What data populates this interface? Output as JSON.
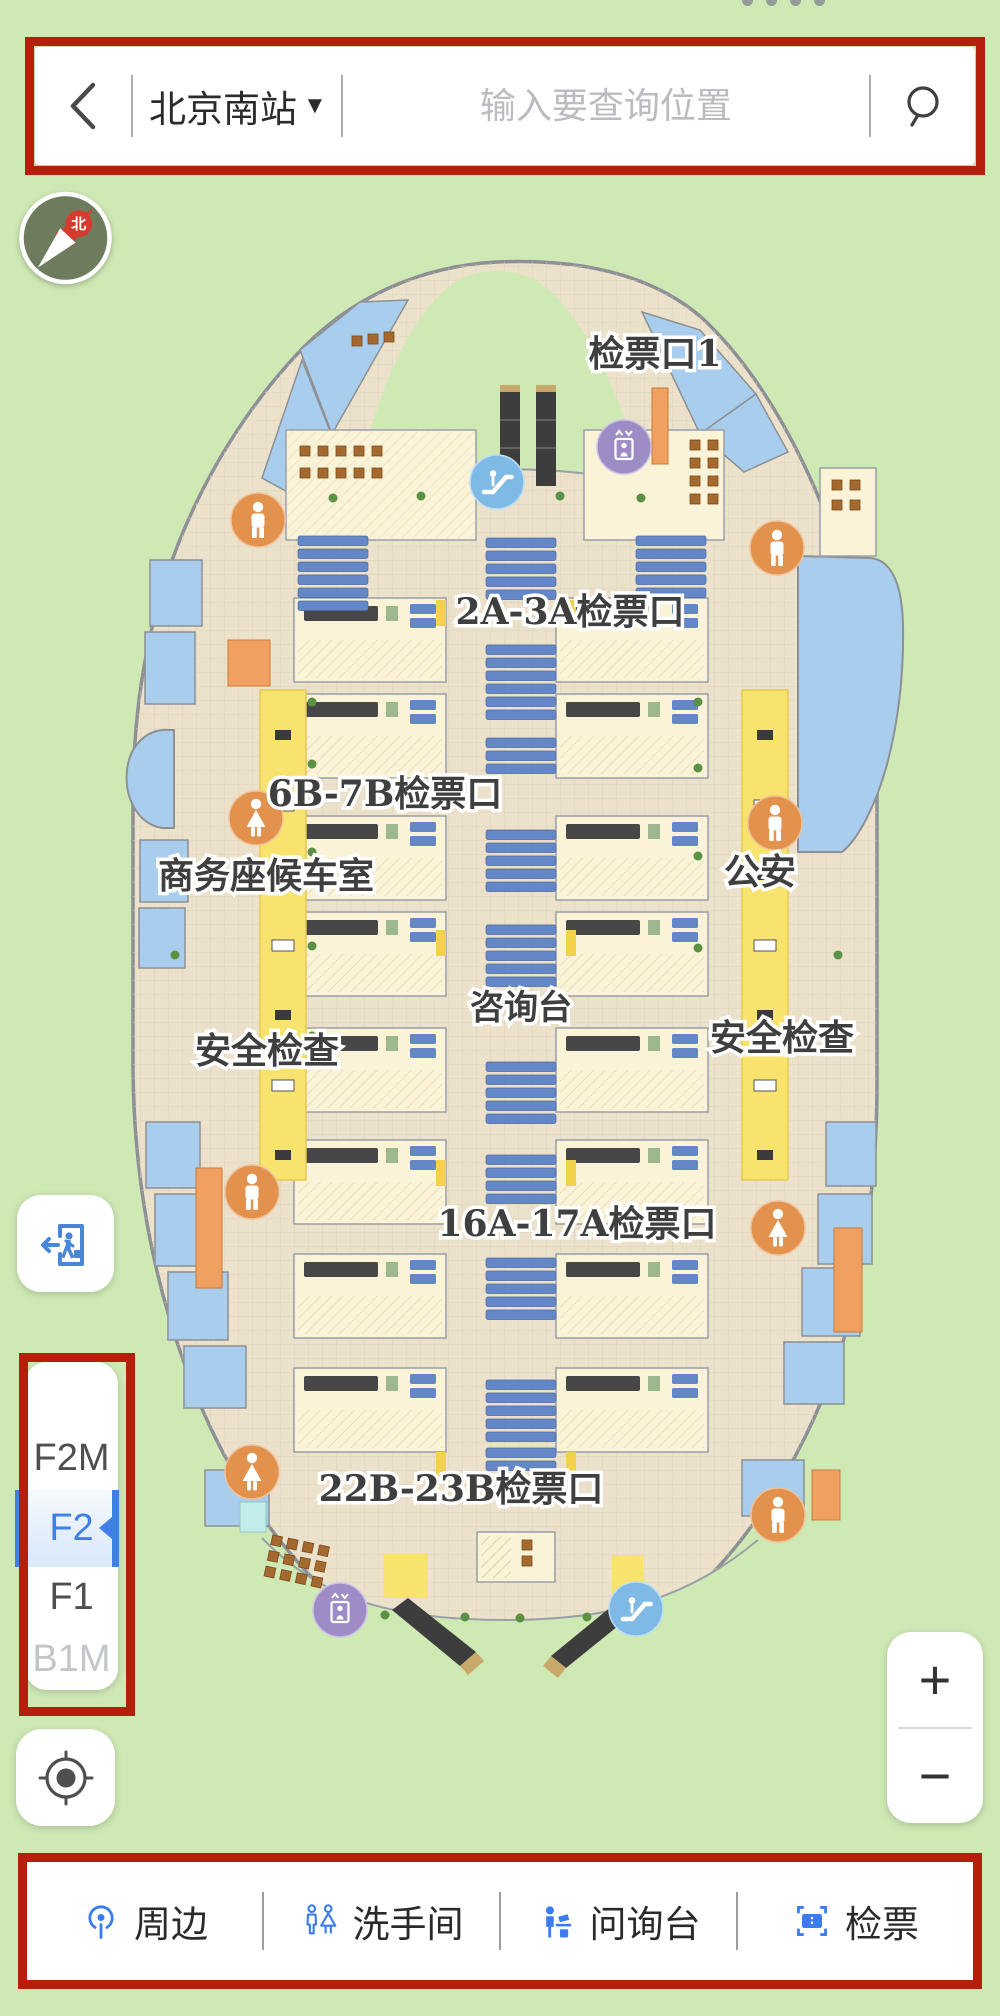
{
  "header": {
    "station_name": "北京南站",
    "dropdown_arrow": "▼",
    "search_placeholder": "输入要查询位置"
  },
  "compass": {
    "north_label": "北"
  },
  "map": {
    "floor_shown": "F2",
    "labels": [
      {
        "text": "检票口1"
      },
      {
        "text": "2A-3A检票口"
      },
      {
        "text": "6B-7B检票口"
      },
      {
        "text": "商务座候车室"
      },
      {
        "text": "公安"
      },
      {
        "text": "咨询台"
      },
      {
        "text": "安全检查"
      },
      {
        "text": "安全检查"
      },
      {
        "text": "16A-17A检票口"
      },
      {
        "text": "22B-23B检票口"
      }
    ],
    "poi_icons": [
      "restroom-male-icon",
      "restroom-male-icon",
      "restroom-male-icon",
      "restroom-male-icon",
      "restroom-male-icon",
      "restroom-female-icon",
      "restroom-female-icon",
      "restroom-female-icon",
      "escalator-icon",
      "escalator-icon",
      "elevator-icon",
      "elevator-icon"
    ]
  },
  "floor_selector": {
    "floors": [
      {
        "label": "F2M"
      },
      {
        "label": "F2",
        "selected": true
      },
      {
        "label": "F1"
      },
      {
        "label": "B1M",
        "disabled": true
      }
    ]
  },
  "zoom_controls": {
    "zoom_in": "+",
    "zoom_out": "−"
  },
  "toolbar": {
    "items": [
      {
        "label": "周边"
      },
      {
        "label": "洗手间"
      },
      {
        "label": "问询台"
      },
      {
        "label": "检票"
      }
    ]
  },
  "colors": {
    "annotation_red": "#b51f0b",
    "background_green": "#cfe9b5",
    "map_floor_beige": "#ece1cb",
    "map_room_blue": "#a9cdec",
    "map_lane_yellow": "#f8e36e",
    "map_room_cream": "#faf3d8",
    "restroom_orange": "#e2924d",
    "elevator_purple": "#9d8cc6",
    "escalator_blue": "#7fb9e6",
    "seat_blue": "#6487c7",
    "accent_blue": "#3e7fe8"
  }
}
